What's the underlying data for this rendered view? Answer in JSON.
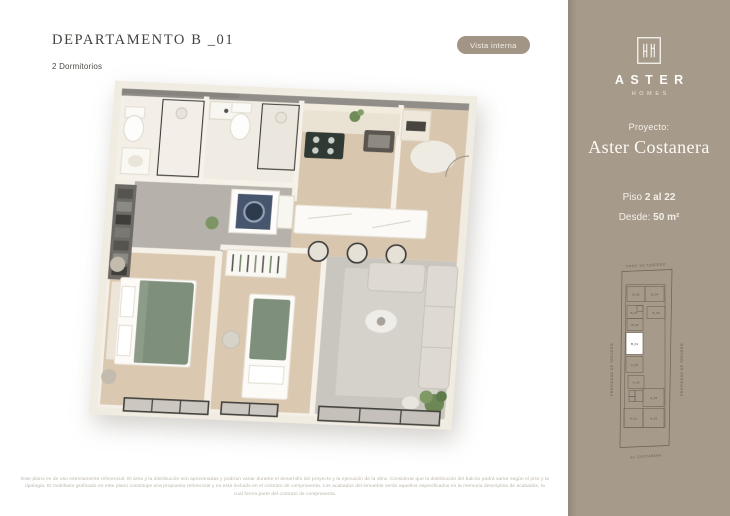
{
  "header": {
    "title": "DEPARTAMENTO B _01",
    "subtitle": "2 Dormitorios",
    "view_button_label": "Vista interna"
  },
  "nav": {
    "back_arrow_glyph": "←"
  },
  "sidebar": {
    "logo": {
      "brand": "ASTER",
      "sub_brand": "HOMES"
    },
    "project_label": "Proyecto:",
    "project_name": "Aster Costanera",
    "floor_label": "Piso",
    "floor_value": "2 al 22",
    "from_label": "Desde:",
    "from_value": "50 m²",
    "keyplan": {
      "top_label": "PROP. DE TERCERO",
      "bottom_label": "AV. COSTANERA",
      "left_label": "PROPIEDAD DE TERCERO",
      "right_label": "PROPIEDAD DE TERCERO",
      "highlighted_unit": "B_01",
      "units": {
        "b05": "B_05",
        "b04": "B_04",
        "b07": "B_07",
        "b06": "B_06",
        "b02": "B_02",
        "b01": "B_01",
        "a06": "A_06",
        "a04": "A_04",
        "a03": "A_03",
        "a01": "A_01",
        "a02": "A_02"
      }
    }
  },
  "footer": {
    "disclaimer_lines": [
      "Este plano es de uso estrictamente referencial. El área y la distribución son aproximadas y podrían variar durante el desarrollo del proyecto y la ejecución de la obra. Considerar que la distribución del balcón podrá variar según el piso y la",
      "tipología. El mobiliario graficado en este plano constituye una propuesta referencial y no está incluido en el contrato de compraventa. Los acabados del inmueble serán aquellos especificados en la memoria descriptiva de acabados, la",
      "cual forma parte del contrato de compraventa."
    ]
  },
  "colors": {
    "sidebar_bg": "#a69a8b",
    "button_bg": "#a39585",
    "sidebar_text": "#fdfbf6",
    "title_text": "#45423e",
    "disclaimer_text": "#bcb5ab",
    "keyplan_line": "#6b6154",
    "highlight_unit_bg": "#ffffff",
    "bed_green": "#7e8f7b",
    "wood_floor": "#d9c6ae"
  }
}
